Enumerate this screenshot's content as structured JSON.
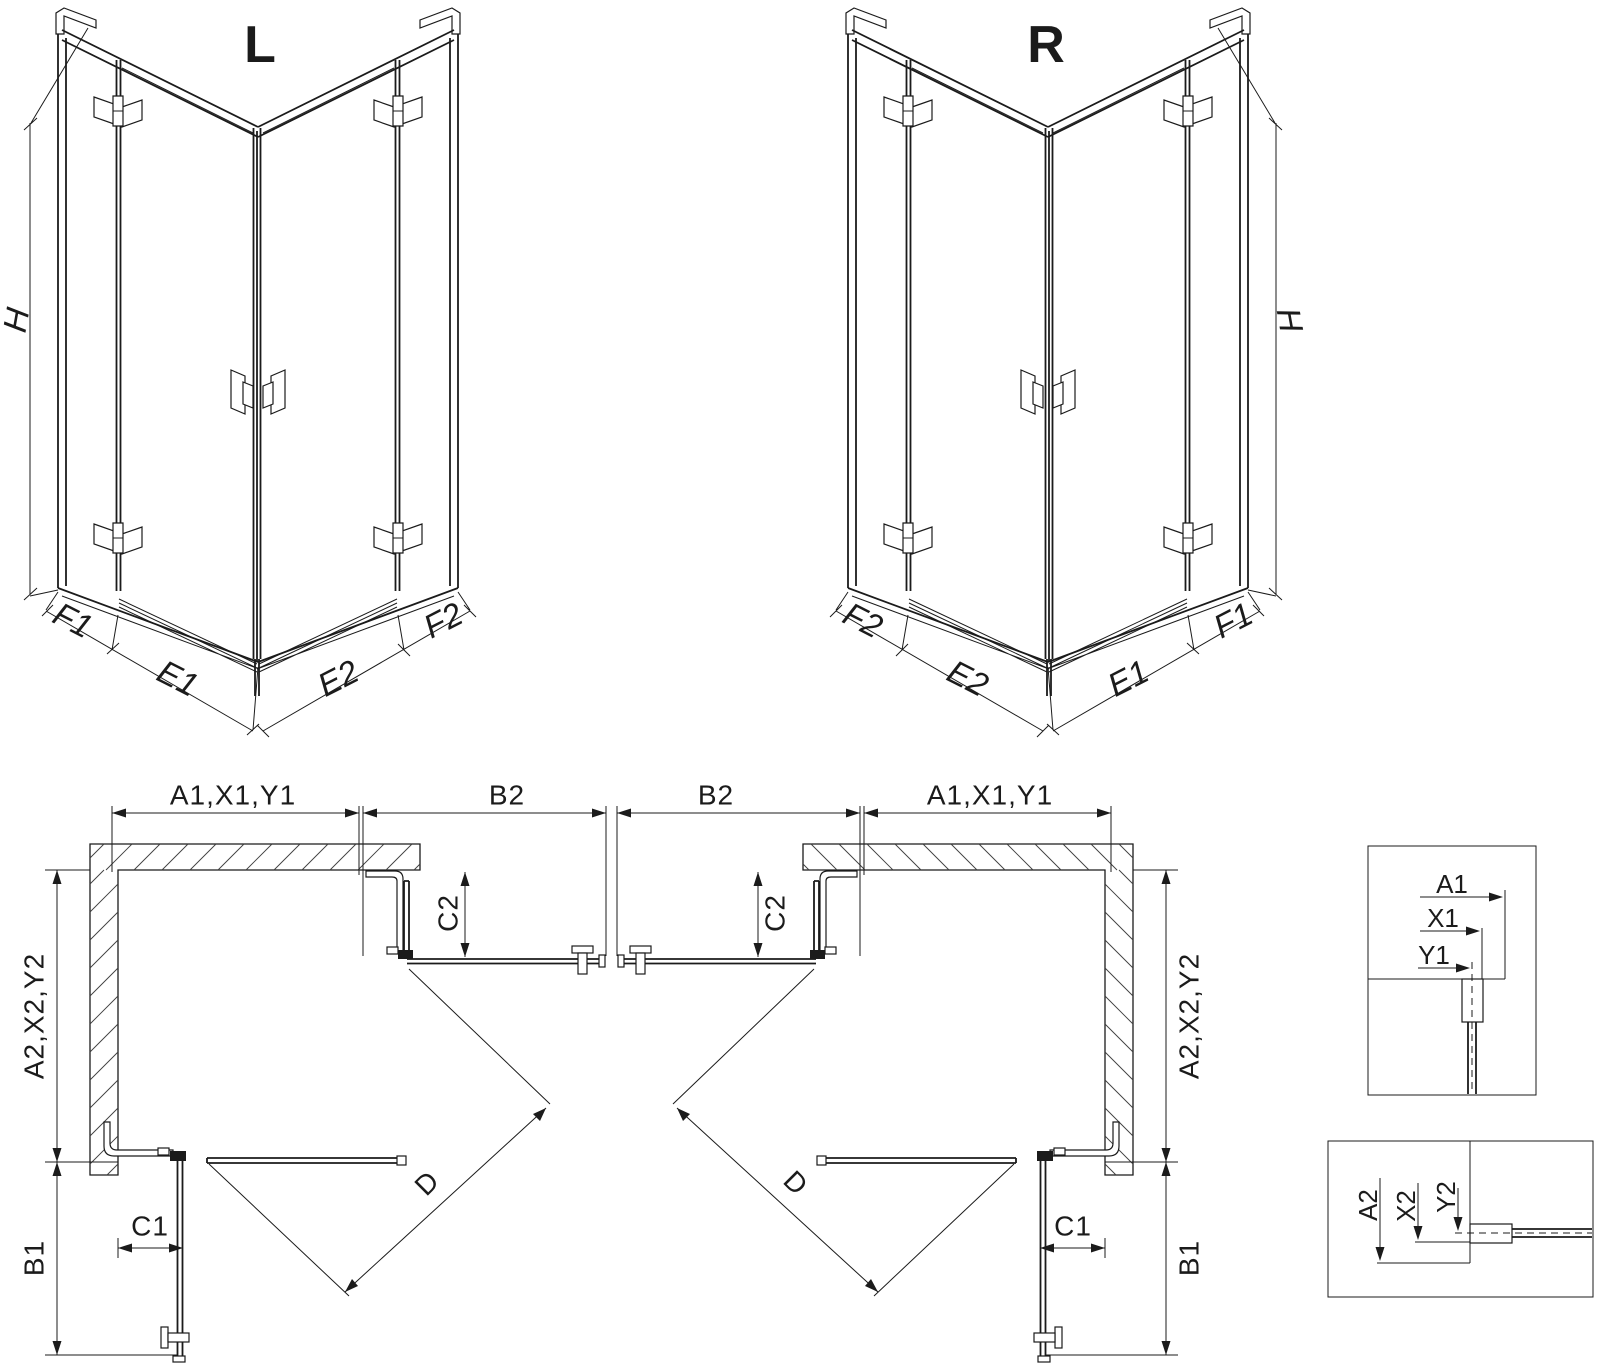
{
  "colors": {
    "line": "#1b1b1b",
    "background": "#ffffff",
    "hatch": "#3f3f3f"
  },
  "iso_left": {
    "title": "L",
    "h": "H",
    "f1": "F1",
    "e1": "E1",
    "e2": "E2",
    "f2": "F2"
  },
  "iso_right": {
    "title": "R",
    "h": "H",
    "f2": "F2",
    "e2": "E2",
    "e1": "E1",
    "f1": "F1"
  },
  "plan_left": {
    "a1": "A1,X1,Y1",
    "b2": "B2",
    "c2": "C2",
    "a2": "A2,X2,Y2",
    "b1": "B1",
    "c1": "C1",
    "d": "D"
  },
  "plan_right": {
    "b2": "B2",
    "a1": "A1,X1,Y1",
    "c2": "C2",
    "a2": "A2,X2,Y2",
    "d": "D",
    "c1": "C1",
    "b1": "B1"
  },
  "detail_top": {
    "a1": "A1",
    "x1": "X1",
    "y1": "Y1"
  },
  "detail_bottom": {
    "a2": "A2",
    "x2": "X2",
    "y2": "Y2"
  }
}
